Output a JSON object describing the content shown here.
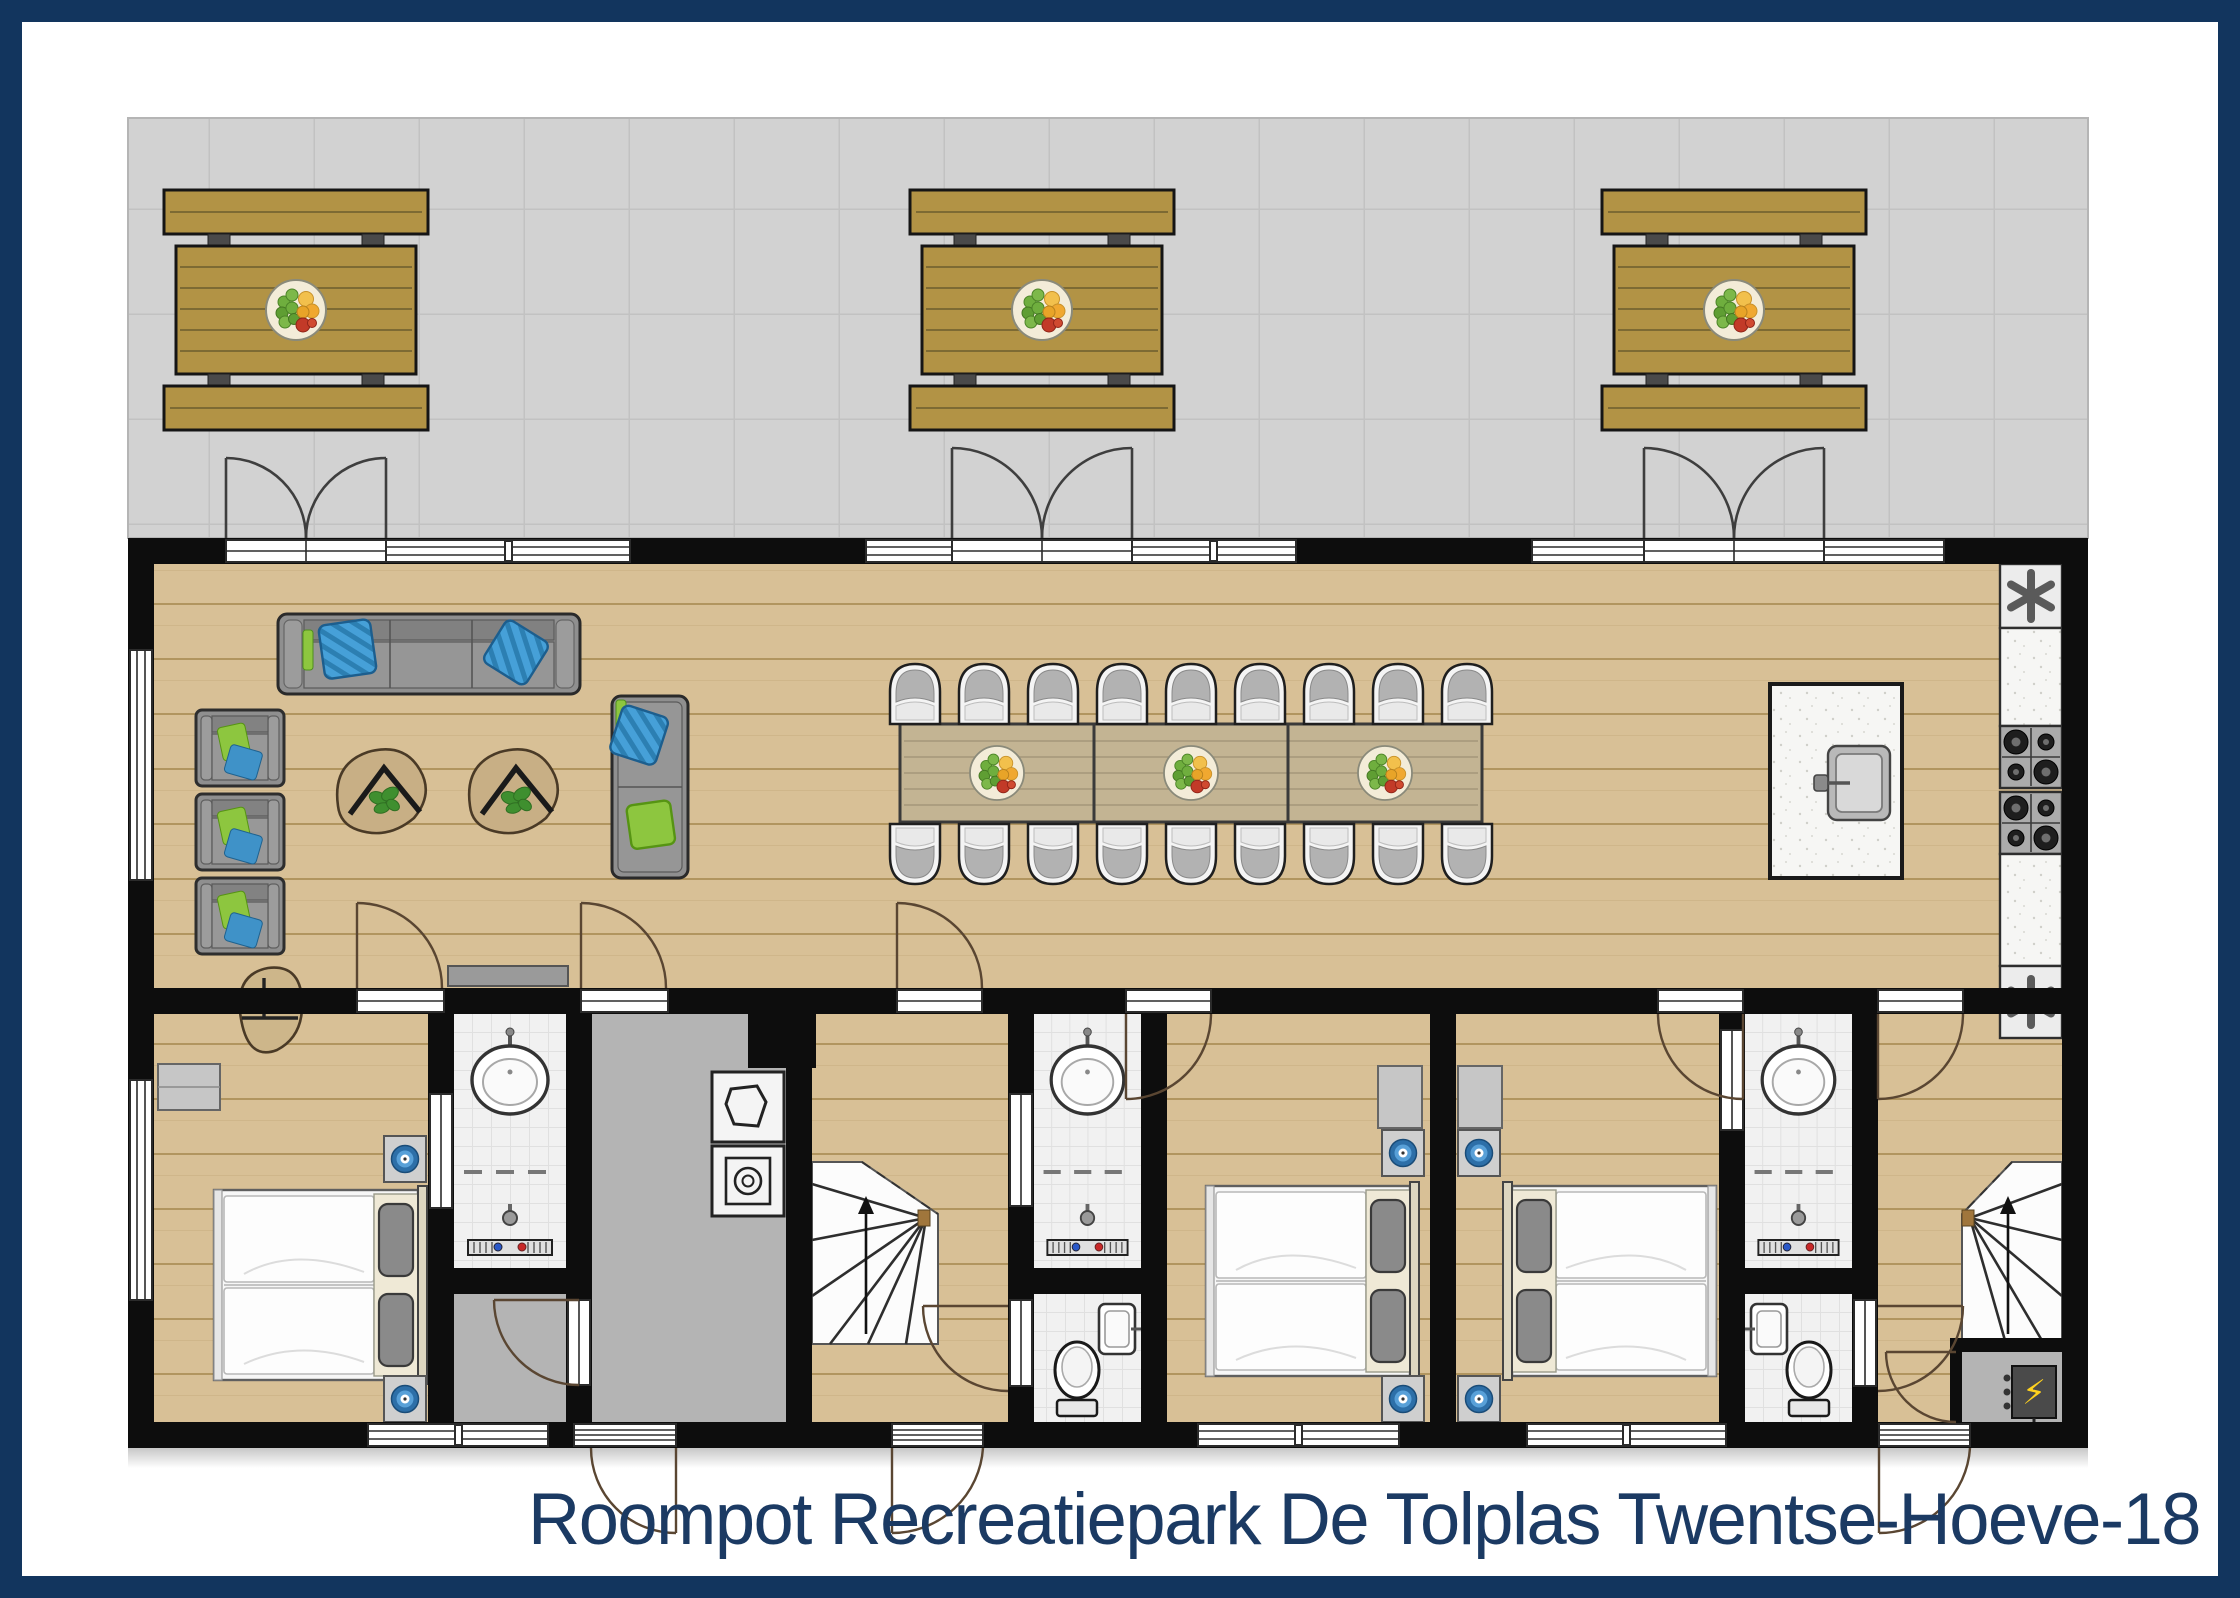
{
  "title": "Roompot Recreatiepark De Tolplas Twentse-Hoeve-18",
  "colors": {
    "frame_navy": "#12355e",
    "title_navy": "#1b3a63",
    "wall_black": "#0d0d0d",
    "wood_floor": "#d8c096",
    "terrace_gray": "#d2d2d2",
    "hall_gray": "#b4b4b4",
    "bath_tile": "#f1f1f1",
    "furniture_gray": "#8f8f8f",
    "pillow_blue": "#46a0d8",
    "pillow_green": "#8dc63f",
    "lamp_blue": "#2d6fa8",
    "picnic_wood": "#b29345",
    "meter_yellow": "#ffd21e"
  },
  "icons": {
    "kitchen_unit": "asterisk",
    "meter": "lightning-bolt",
    "stairs_direction": "arrow-up",
    "washing_machine": "drum-circle",
    "boiler": "pentagon-outline"
  },
  "utility": {
    "meter_symbol": "⚡"
  },
  "counts": {
    "picnic_tables": 3,
    "terrace_double_doors": 3,
    "dining_chairs": 18,
    "dining_table_sections": 3,
    "fruit_bowls_inside": 3,
    "sofas": 2,
    "armchairs": 3,
    "lounge_chairs": 2,
    "bedrooms": 3,
    "double_beds": 3,
    "shower_rooms": 3,
    "toilet_rooms": 2,
    "staircases": 2,
    "hobs": 2,
    "tall_kitchen_units": 2,
    "kitchen_island_sinks": 1,
    "washing_machines": 1,
    "boilers": 1
  }
}
